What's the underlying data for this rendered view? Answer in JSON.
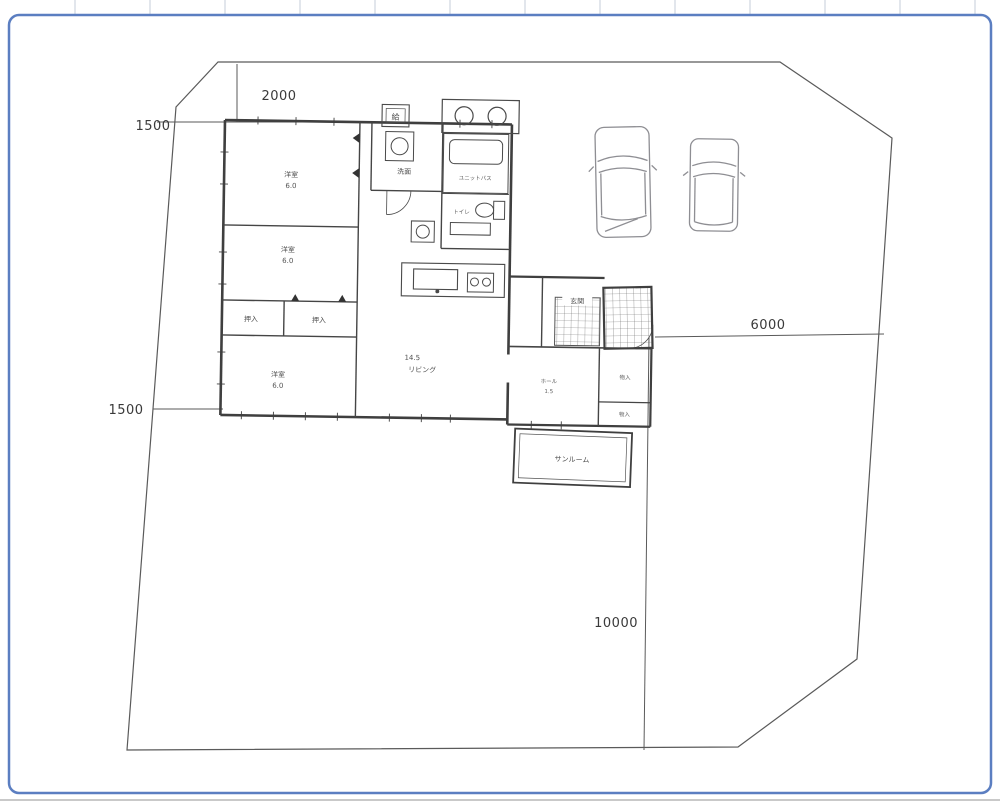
{
  "document": {
    "type": "scanned site and floor plan"
  },
  "colors": {
    "frame_border": "#5b7ec1",
    "plan_line": "#3f3f3f",
    "site_line": "#5a5a5a",
    "car_line": "#8e8e93",
    "grid_tick": "#c6ccd8"
  },
  "dimensions": {
    "top": "2000",
    "left_upper": "1500",
    "left_lower": "1500",
    "right": "6000",
    "bottom": "10000"
  },
  "rooms": {
    "bedroom1_name": "洋室",
    "bedroom1_area": "6.0",
    "bedroom2_name": "洋室",
    "bedroom2_area": "6.0",
    "bedroom3_name": "洋室",
    "bedroom3_area": "6.0",
    "closet_left": "押入",
    "closet_right": "押入",
    "living_area": "14.5",
    "living_name": "リビング",
    "washroom": "洗面",
    "bath": "ユニットバス",
    "toilet": "トイレ",
    "entrance": "玄関",
    "hall_name": "ホール",
    "hall_area": "1.5",
    "storage_upper": "物入",
    "storage_lower": "物入",
    "sunroom": "サンルーム",
    "water_heater": "給"
  }
}
